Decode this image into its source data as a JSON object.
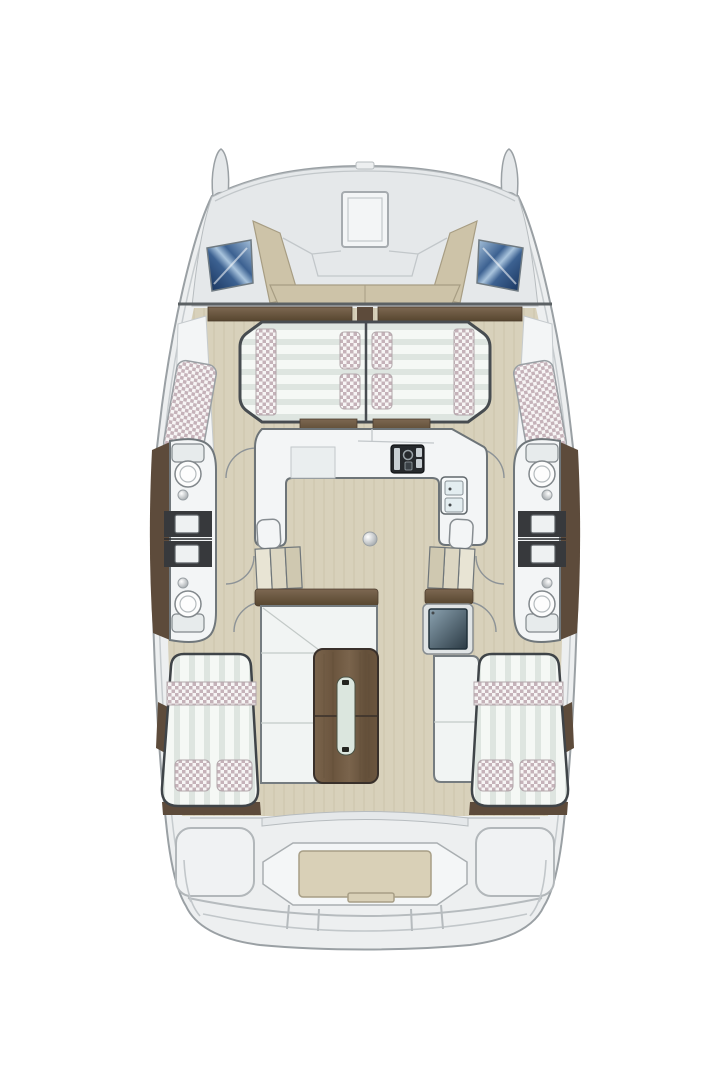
{
  "document": {
    "subject": "Top-down floor plan diagram of a sailing catamaran showing deck and interior layout",
    "view": "top-down",
    "vessel_type": "catamaran",
    "visible_text": []
  },
  "colors": {
    "pageBg": "#ffffff",
    "hullFill": "#edeff0",
    "hullStroke": "#9aa0a4",
    "hullInner": "#c6cbce",
    "deck": "#e5e8ea",
    "deckSeam": "#c2c7ca",
    "line1": "#b7bcbf",
    "bench": "#cdc3a8",
    "benchEdge": "#a79d83",
    "bulkhead": "#5c6164",
    "floor": "#d8d1bb",
    "floorGrain": "#c7bfa4",
    "trimLight": "#7d6852",
    "trimDark": "#57462f",
    "trim": "#5d4b3b",
    "edgeDark": "#474c50",
    "unit": "#f3f5f6",
    "unitStroke": "#70777b",
    "counterDark": "#37393c",
    "fixtureStroke": "#82888c",
    "mattBase": "#f5f8f5",
    "mattStripe": "#dee5e0",
    "pillowBase": "#f7f5f5",
    "pillowCheck": "#c5b2b9",
    "winDark": "#16315a",
    "winMid": "#3c6191",
    "winLight": "#a9c4dd",
    "woodLight": "#7a644c",
    "wood": "#6b553e",
    "woodDark": "#64503a",
    "tableEdge": "#39302a",
    "glass": "#dbe6de",
    "screenLight": "#8ba2b0",
    "screenDark": "#2b3a44",
    "arc": "#8d9397",
    "sofa": "#f1f4f3",
    "sofaStroke": "#757c80",
    "seam": "#c2c9c7",
    "stairA": "#e8e4d4",
    "stairB": "#dcd6c2",
    "stairC": "#cfc8b0",
    "platform": "#f4f6f7",
    "platformStroke": "#a9aeb1",
    "sternStep": "#d9d0b7",
    "sternStepEdge": "#a79e86",
    "sternLine": "#b6bbbe",
    "knobHi": "#ffffff",
    "knobLo": "#999fa3"
  },
  "features": [
    {
      "name": "port-bow-fin",
      "kind": "hull"
    },
    {
      "name": "starboard-bow-fin",
      "kind": "hull"
    },
    {
      "name": "foredeck",
      "kind": "deck"
    },
    {
      "name": "foredeck-hatch",
      "kind": "hatch"
    },
    {
      "name": "port-front-window",
      "kind": "window"
    },
    {
      "name": "starboard-front-window",
      "kind": "window"
    },
    {
      "name": "forward-cockpit-seating",
      "kind": "seating",
      "details": "U-shaped beige bench"
    },
    {
      "name": "forward-double-berth",
      "kind": "berth",
      "details": "split port/starboard halves, 4 checkered pillows, 2 quilted runners"
    },
    {
      "name": "port-forward-hull-berth",
      "kind": "berth"
    },
    {
      "name": "starboard-forward-hull-berth",
      "kind": "berth"
    },
    {
      "name": "port-bathrooms",
      "kind": "bathroom",
      "details": "2 toilets, 2 sinks on dark counters"
    },
    {
      "name": "starboard-bathrooms",
      "kind": "bathroom",
      "details": "2 toilets, 2 sinks on dark counters"
    },
    {
      "name": "galley",
      "kind": "galley",
      "details": "U-shaped white counter, stove, double sink"
    },
    {
      "name": "mast-post",
      "kind": "structure"
    },
    {
      "name": "port-companionway-stairs",
      "kind": "stairs",
      "details": "3 steps"
    },
    {
      "name": "starboard-companionway-stairs",
      "kind": "stairs",
      "details": "3 steps"
    },
    {
      "name": "salon-sofa",
      "kind": "seating",
      "details": "L-shaped, wood backrest"
    },
    {
      "name": "dining-table",
      "kind": "table",
      "details": "two-leaf wood table with glass insert"
    },
    {
      "name": "chart-table",
      "kind": "navigation"
    },
    {
      "name": "starboard-bench",
      "kind": "seating"
    },
    {
      "name": "port-aft-berth",
      "kind": "berth",
      "details": "double bed, checkered runner, 2 pillows"
    },
    {
      "name": "starboard-aft-berth",
      "kind": "berth",
      "details": "double bed, checkered runner, 2 pillows"
    },
    {
      "name": "cockpit",
      "kind": "deck"
    },
    {
      "name": "swim-platform-step",
      "kind": "deck"
    },
    {
      "name": "transom",
      "kind": "hull"
    }
  ]
}
